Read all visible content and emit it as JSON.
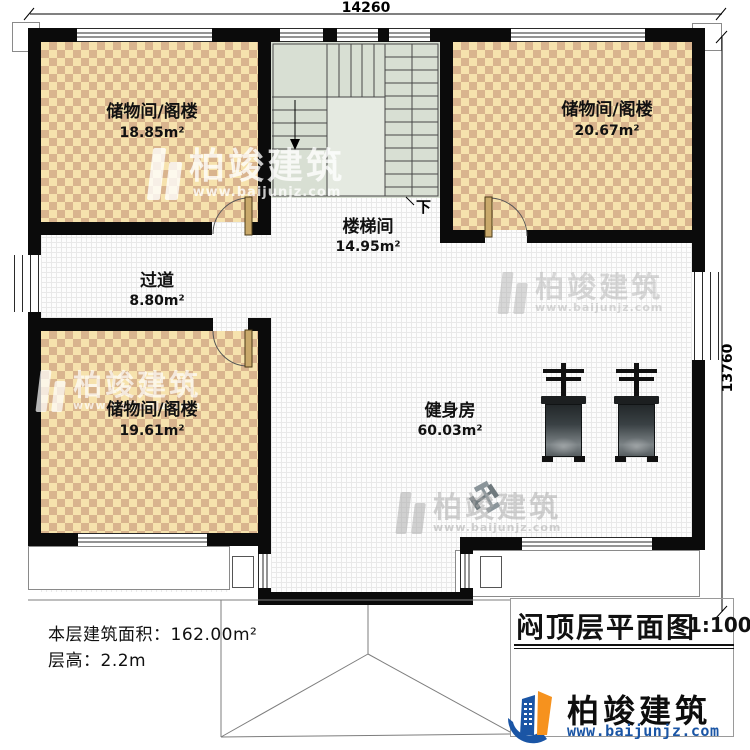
{
  "dimensions": {
    "top": "14260",
    "right": "13760"
  },
  "rooms": {
    "storage_tl": {
      "name": "储物间/阁楼",
      "area": "18.85m²"
    },
    "storage_tr": {
      "name": "储物间/阁楼",
      "area": "20.67m²"
    },
    "storage_bl": {
      "name": "储物间/阁楼",
      "area": "19.61m²"
    },
    "stairwell": {
      "name": "楼梯间",
      "area": "14.95m²"
    },
    "corridor": {
      "name": "过道",
      "area": "8.80m²"
    },
    "gym": {
      "name": "健身房",
      "area": "60.03m²"
    }
  },
  "stairs": {
    "down_label": "下"
  },
  "info": {
    "floor_area": "本层建筑面积：162.00m²",
    "floor_height": "层高：2.2m"
  },
  "title_block": {
    "title": "闷顶层平面图",
    "scale": "1:100"
  },
  "brand": {
    "name": "柏竣建筑",
    "url": "www.baijunjz.com",
    "logo_icon": "building-swoosh-logo"
  },
  "watermark": {
    "name": "柏竣建筑",
    "url": "www.baijunjz.com"
  },
  "colors": {
    "wall": "#0b0b0b",
    "checker_light": "#f6e2ad",
    "checker_dark": "#d9b48e",
    "stair_floor": "#d8dfd3",
    "brand_blue": "#1a55a5",
    "brand_orange": "#f6921e"
  }
}
